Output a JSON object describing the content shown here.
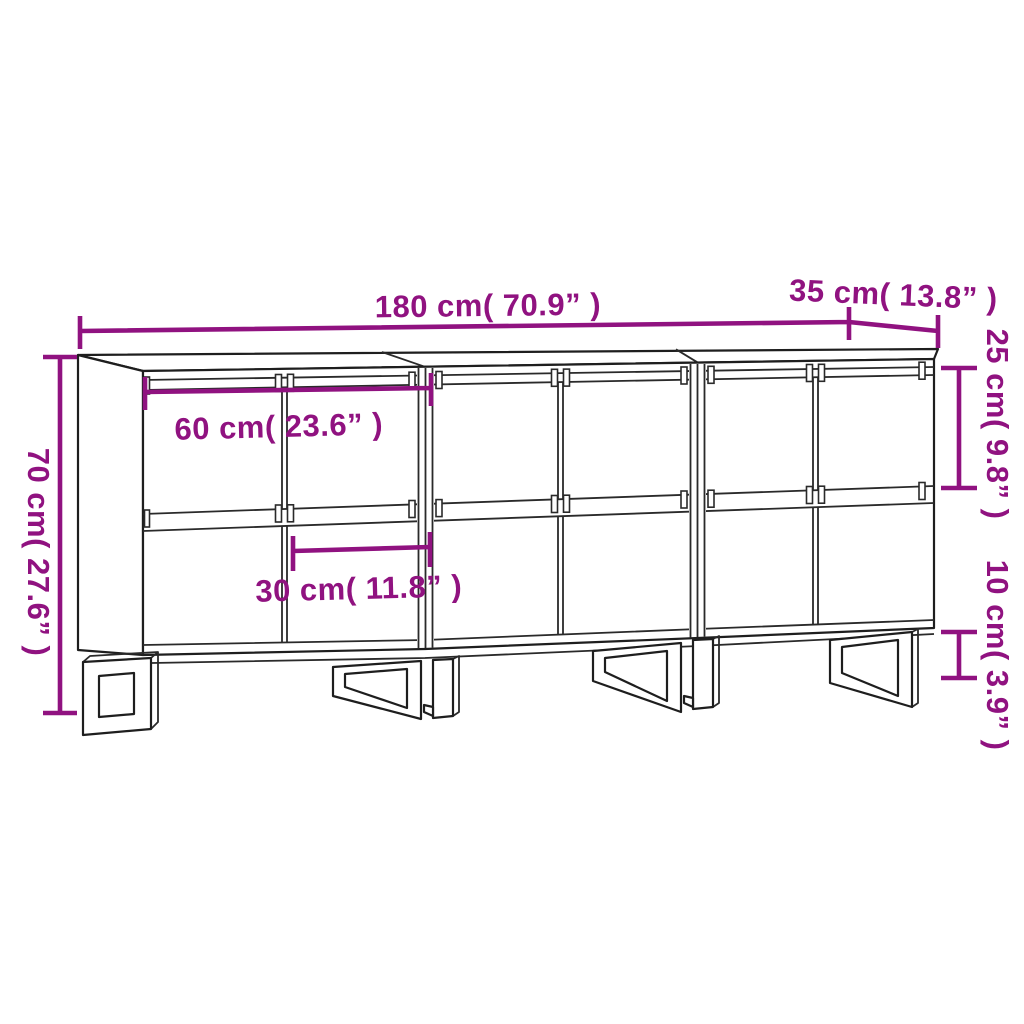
{
  "diagram": {
    "title": "Sideboard dimension drawing",
    "colors": {
      "dimension_annotation": "#901280",
      "line_art": "#1e1e1e",
      "background": "#FFFFFF"
    },
    "dimensions": {
      "total_width": {
        "label": "180 cm( 70.9” )",
        "cm": 180,
        "inches": 70.9
      },
      "depth": {
        "label": "35 cm( 13.8” )",
        "cm": 35,
        "inches": 13.8
      },
      "total_height": {
        "label": "70 cm( 27.6” )",
        "cm": 70,
        "inches": 27.6
      },
      "section_width": {
        "label": "60 cm( 23.6” )",
        "cm": 60,
        "inches": 23.6
      },
      "door_width": {
        "label": "30 cm( 11.8” )",
        "cm": 30,
        "inches": 11.8
      },
      "upper_door_height": {
        "label": "25 cm( 9.8” )",
        "cm": 25,
        "inches": 9.8
      },
      "leg_height": {
        "label": "10 cm( 3.9” )",
        "cm": 10,
        "inches": 3.9
      }
    }
  }
}
